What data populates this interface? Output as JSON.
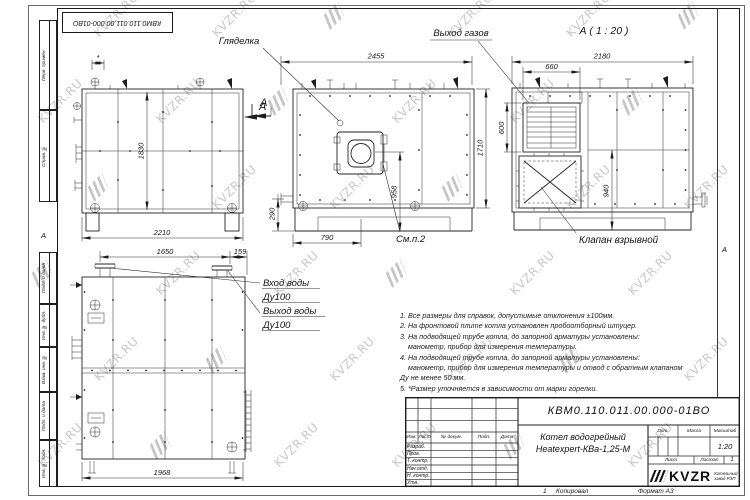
{
  "watermark": {
    "text": "KVZR.RU"
  },
  "frame": {
    "stamp": "КВМ0.110.011.00.000-01ВО",
    "margins": [
      "Перв. примен.",
      "Справ. №",
      "Подп. и дата",
      "Инв. № дубл.",
      "Взам. инв. №",
      "Подп. и дата",
      "Инв. № подл."
    ],
    "fold_left": "А",
    "fold_right": "А"
  },
  "callouts": {
    "sight_glass": "Гляделка",
    "gas_outlet": "Выход газов",
    "view_a": "А ( 1 : 20 )",
    "section_a": "А",
    "see_note": "См.п.2",
    "explosion_valve": "Клапан взрывной",
    "water_in": "Вход воды",
    "water_in_dn": "Ду100",
    "water_out": "Выход воды",
    "water_out_dn": "Ду100"
  },
  "dims": {
    "front_width": "2455",
    "front_height": "1710",
    "front_burner_center": "958",
    "front_burner_x": "790",
    "front_base": "290",
    "rear_width": "2180",
    "louver_width": "660",
    "louver_height": "600",
    "rear_lower": "940",
    "side_width": "2210",
    "side_height": "1830",
    "plan_nozzle_span": "1650",
    "plan_nozzle_edge": "159",
    "plan_length": "1968",
    "star": "*"
  },
  "notes": [
    "1. Все размеры для справок, допустимые отклонения ±100мм.",
    "2. На фронтовой плите котла установлен пробоотборный штуцер.",
    "3. На подводящей трубе котла, до запорной арматуры установлены:",
    "    манометр, прибор для измерения температуры.",
    "4. На подводящей трубе котла, до запорной арматуры установлены:",
    "    манометр, прибор для измерения температуры и отвод с обратным клапаном",
    "Ду не менее 50 мм.",
    "5. *Размер уточняется в зависимости от марки горелки."
  ],
  "titleblock": {
    "doc_number": "КВМ0.110.011.00.000-01ВО",
    "name_line1": "Котел водогрейный",
    "name_line2": "Heatexpert-КВа-1,25-М",
    "col_izm": "Изм.",
    "col_list": "Лист",
    "col_doc": "№ докум.",
    "col_sign": "Подп.",
    "col_date": "Дата",
    "rows": [
      "Разраб.",
      "Пров.",
      "Т. контр.",
      "Нач.отд.",
      "Н. контр.",
      "Утв."
    ],
    "lit": "Лит.",
    "mass": "Масса",
    "scale": "Масштаб",
    "scale_value": "1:20",
    "sheet": "Лист",
    "sheets": "Листов",
    "sheets_value": "1",
    "logo": "KVZR",
    "logo_caption1": "Котельный",
    "logo_caption2": "завод РЭП",
    "fold_number": "1",
    "copy": "Копировал",
    "format": "Формат А3"
  }
}
